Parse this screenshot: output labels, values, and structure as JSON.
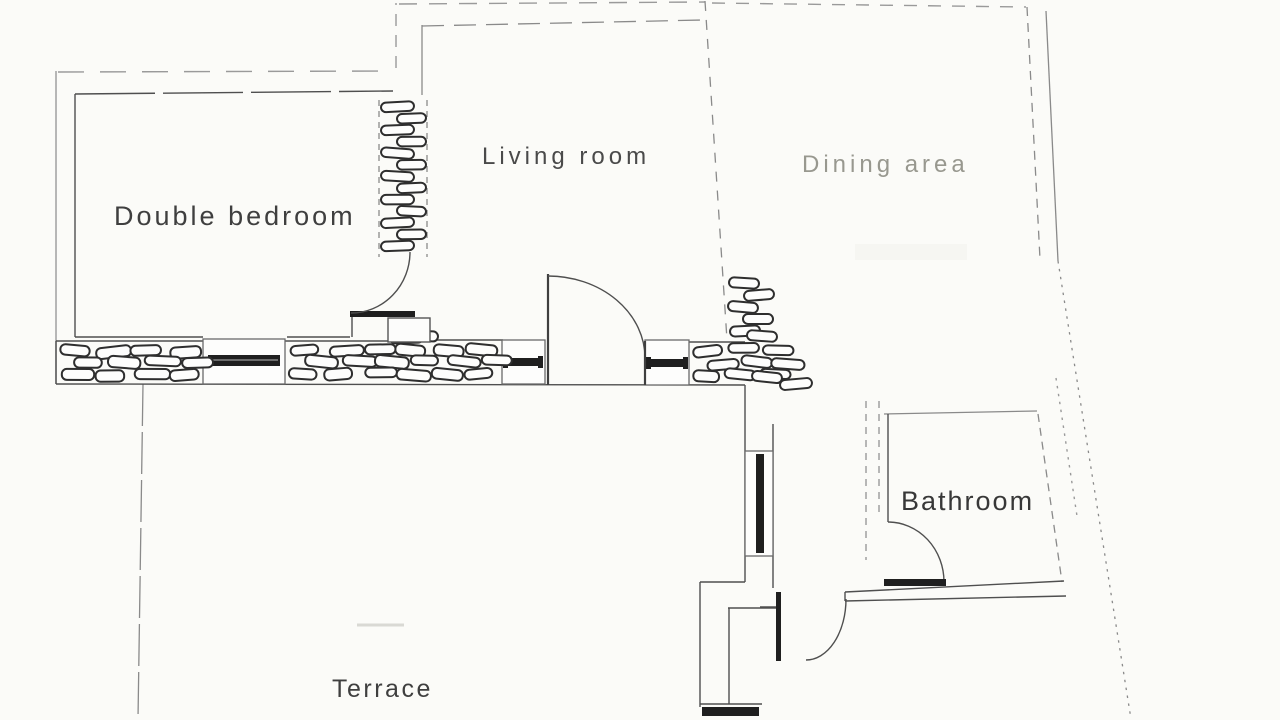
{
  "plan": {
    "background_color": "#fbfbf8",
    "ink_color": "#4a4a4a",
    "faded_ink_color": "#98988f",
    "window_glass_color": "#1f1f1f",
    "stone_outline_color": "#2e2e2e",
    "rooms": [
      {
        "id": "double-bedroom",
        "label": "Double bedroom"
      },
      {
        "id": "living-room",
        "label": "Living room"
      },
      {
        "id": "dining-area",
        "label": "Dining area",
        "faded": true
      },
      {
        "id": "bathroom",
        "label": "Bathroom"
      },
      {
        "id": "terrace",
        "label": "Terrace"
      }
    ]
  }
}
